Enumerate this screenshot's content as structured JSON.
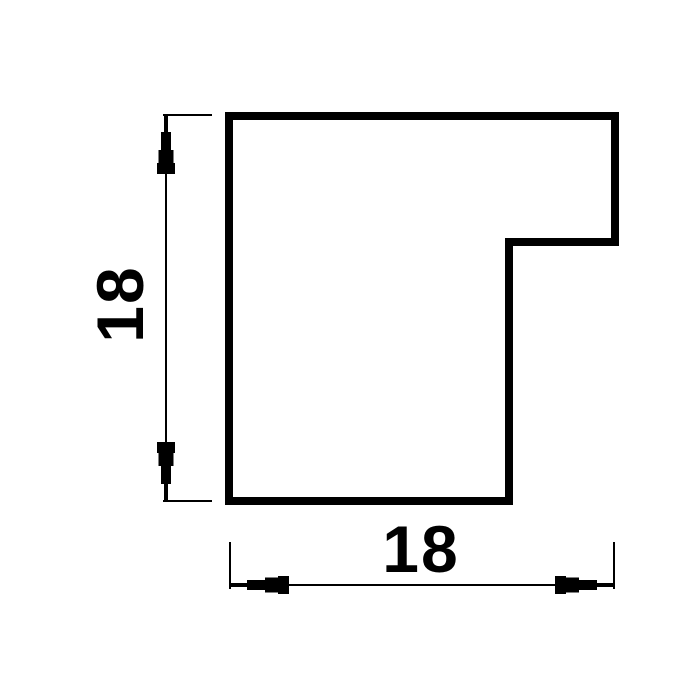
{
  "drawing": {
    "background_color": "#ffffff",
    "line_color": "#000000",
    "profile": {
      "name": "stepped-moulding-cross-section"
    },
    "dimensions": {
      "vertical": {
        "value": "18"
      },
      "horizontal": {
        "value": "18"
      }
    }
  }
}
